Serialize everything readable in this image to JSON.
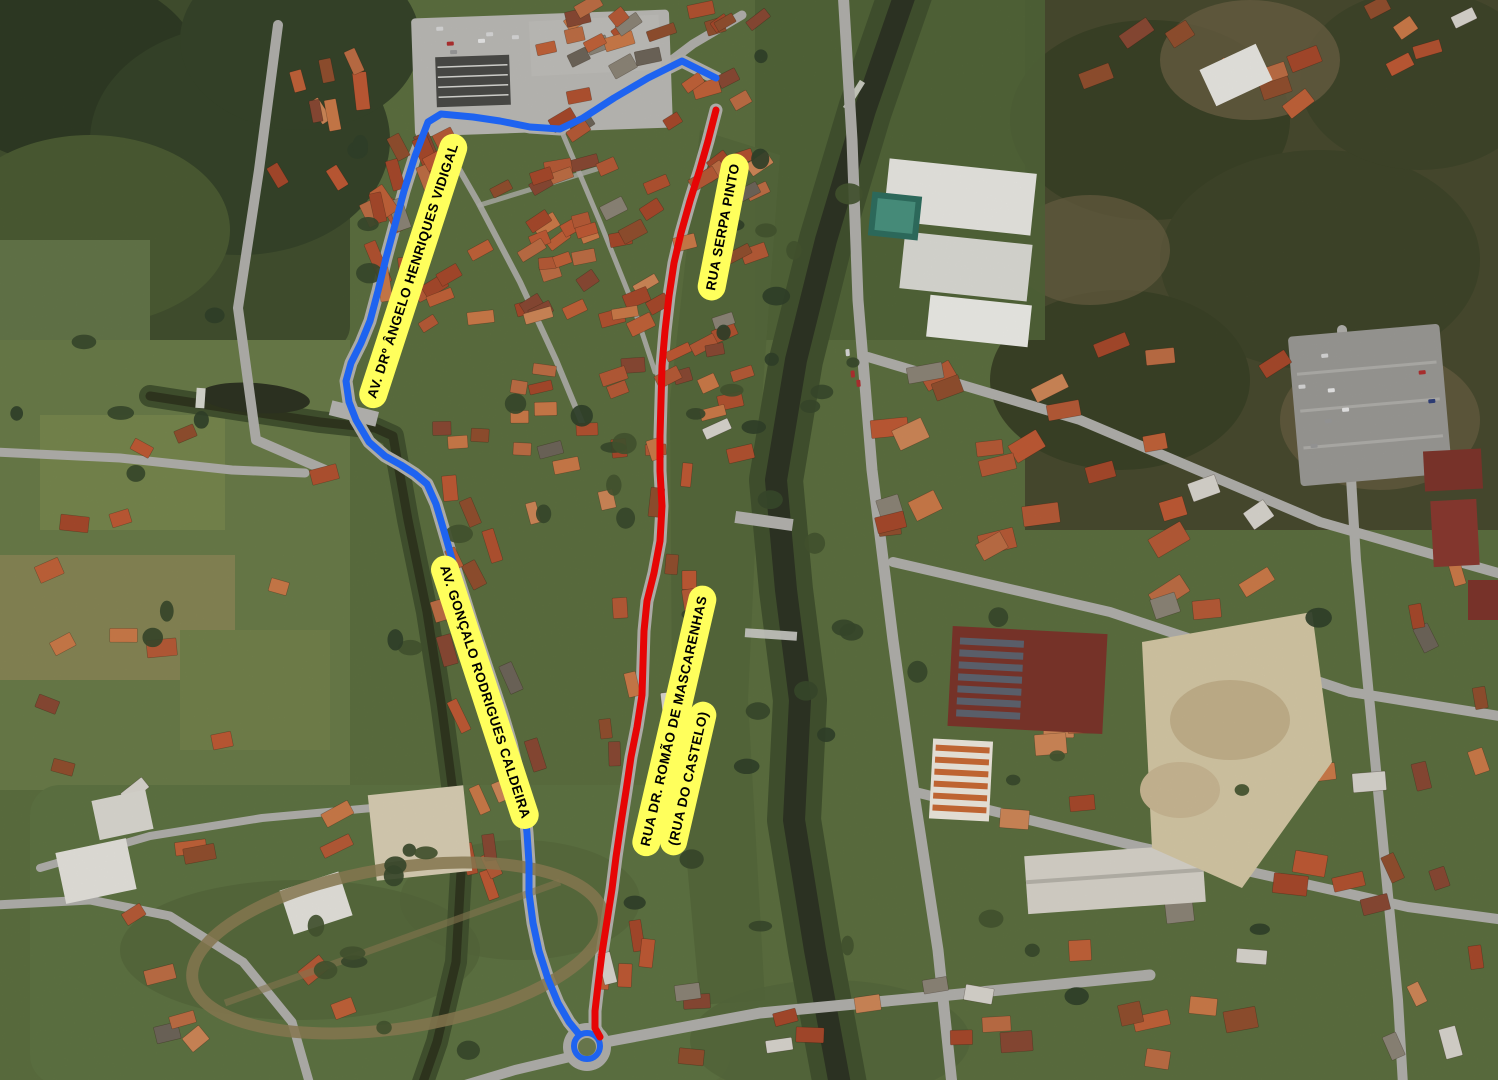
{
  "map": {
    "kind": "aerial-satellite-route-map",
    "label_style": {
      "background": "#ffff5c",
      "text_color": "#000000"
    },
    "street_labels": [
      {
        "id": "av-dr-angelo-henriques-vidigal",
        "lines": [
          "AV. DRº ÂNGELO HENRIQUES VIDIGAL"
        ],
        "x": 413,
        "y": 271,
        "rotation_deg": -72
      },
      {
        "id": "rua-serpa-pinto",
        "lines": [
          "RUA SERPA PINTO"
        ],
        "x": 723,
        "y": 227,
        "rotation_deg": -79
      },
      {
        "id": "av-goncalo-rodrigues-caldeira",
        "lines": [
          "AV. GONÇALO RODRIGUES CALDEIRA"
        ],
        "x": 485,
        "y": 692,
        "rotation_deg": 72
      },
      {
        "id": "rua-dr-romao-de-mascarenhas",
        "lines": [
          "RUA DR. ROMÃO DE MASCARENHAS",
          "(RUA DO CASTELO)"
        ],
        "x": 687,
        "y": 724,
        "rotation_deg": -77
      }
    ],
    "routes": [
      {
        "id": "route-blue",
        "color": "#1e63f0",
        "width": 7,
        "points": [
          [
            716,
            78
          ],
          [
            682,
            61
          ],
          [
            648,
            78
          ],
          [
            614,
            98
          ],
          [
            583,
            118
          ],
          [
            560,
            129
          ],
          [
            530,
            127
          ],
          [
            500,
            121
          ],
          [
            473,
            117
          ],
          [
            441,
            114
          ],
          [
            428,
            122
          ],
          [
            415,
            156
          ],
          [
            404,
            191
          ],
          [
            396,
            221
          ],
          [
            386,
            258
          ],
          [
            378,
            291
          ],
          [
            370,
            321
          ],
          [
            361,
            343
          ],
          [
            351,
            363
          ],
          [
            346,
            381
          ],
          [
            349,
            402
          ],
          [
            356,
            420
          ],
          [
            369,
            442
          ],
          [
            385,
            456
          ],
          [
            401,
            465
          ],
          [
            415,
            474
          ],
          [
            427,
            484
          ],
          [
            436,
            504
          ],
          [
            444,
            531
          ],
          [
            452,
            559
          ],
          [
            462,
            591
          ],
          [
            472,
            623
          ],
          [
            482,
            653
          ],
          [
            492,
            683
          ],
          [
            502,
            713
          ],
          [
            511,
            743
          ],
          [
            518,
            773
          ],
          [
            524,
            803
          ],
          [
            527,
            833
          ],
          [
            529,
            863
          ],
          [
            529,
            893
          ],
          [
            533,
            923
          ],
          [
            539,
            951
          ],
          [
            548,
            979
          ],
          [
            558,
            1003
          ],
          [
            569,
            1022
          ],
          [
            578,
            1033
          ]
        ],
        "end_marker": {
          "type": "circle",
          "cx": 587,
          "cy": 1046,
          "r": 13
        }
      },
      {
        "id": "route-red",
        "color": "#e60505",
        "width": 7,
        "points": [
          [
            716,
            110
          ],
          [
            708,
            141
          ],
          [
            700,
            169
          ],
          [
            690,
            201
          ],
          [
            681,
            233
          ],
          [
            674,
            263
          ],
          [
            669,
            296
          ],
          [
            665,
            331
          ],
          [
            662,
            366
          ],
          [
            661,
            401
          ],
          [
            660,
            436
          ],
          [
            660,
            471
          ],
          [
            662,
            506
          ],
          [
            660,
            541
          ],
          [
            654,
            573
          ],
          [
            647,
            601
          ],
          [
            644,
            631
          ],
          [
            643,
            663
          ],
          [
            642,
            695
          ],
          [
            637,
            727
          ],
          [
            631,
            757
          ],
          [
            626,
            791
          ],
          [
            621,
            823
          ],
          [
            616,
            857
          ],
          [
            612,
            889
          ],
          [
            607,
            921
          ],
          [
            602,
            953
          ],
          [
            598,
            985
          ],
          [
            595,
            1011
          ],
          [
            595,
            1028
          ],
          [
            600,
            1037
          ]
        ]
      }
    ]
  }
}
